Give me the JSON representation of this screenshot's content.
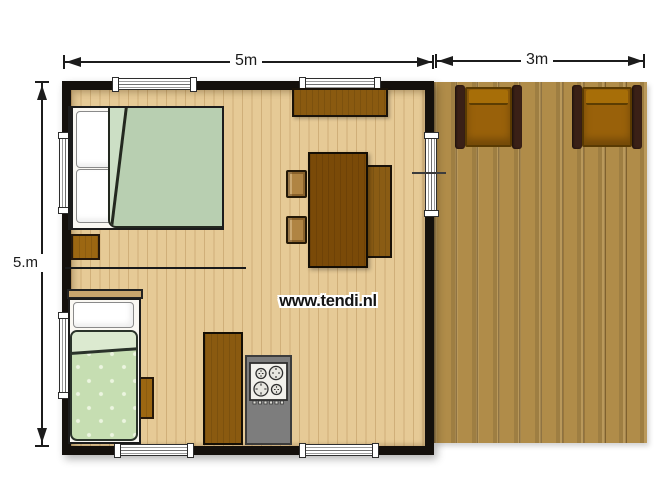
{
  "plan": {
    "type": "floor-plan",
    "watermark": "www.tendi.nl",
    "dimensions": {
      "cabin_width_label": "5m",
      "deck_width_label": "3m",
      "cabin_depth_label": "5.m"
    },
    "colors": {
      "wall": "#14100c",
      "interior_floor": "#e6ca96",
      "deck_floor": "#b08c49",
      "double_bed_duvet": "#b8cfb1",
      "single_bed_duvet": "#c6deb2",
      "furniture_brown": "#8a5a10",
      "table_brown": "#7a4a08",
      "counter_gray": "#7d7d7d",
      "deck_chair_seat": "#99610a",
      "deck_chair_arm": "#3a2016",
      "dimension_ink": "#1c1c1c"
    },
    "elements": [
      "double-bed",
      "single-bed",
      "nightstand",
      "sideboard",
      "dining-table",
      "bench",
      "dining-chairs",
      "kitchen-cabinet",
      "kitchen-counter",
      "stove",
      "deck",
      "deck-chairs",
      "windows",
      "entrance-door",
      "partition-wall"
    ]
  }
}
